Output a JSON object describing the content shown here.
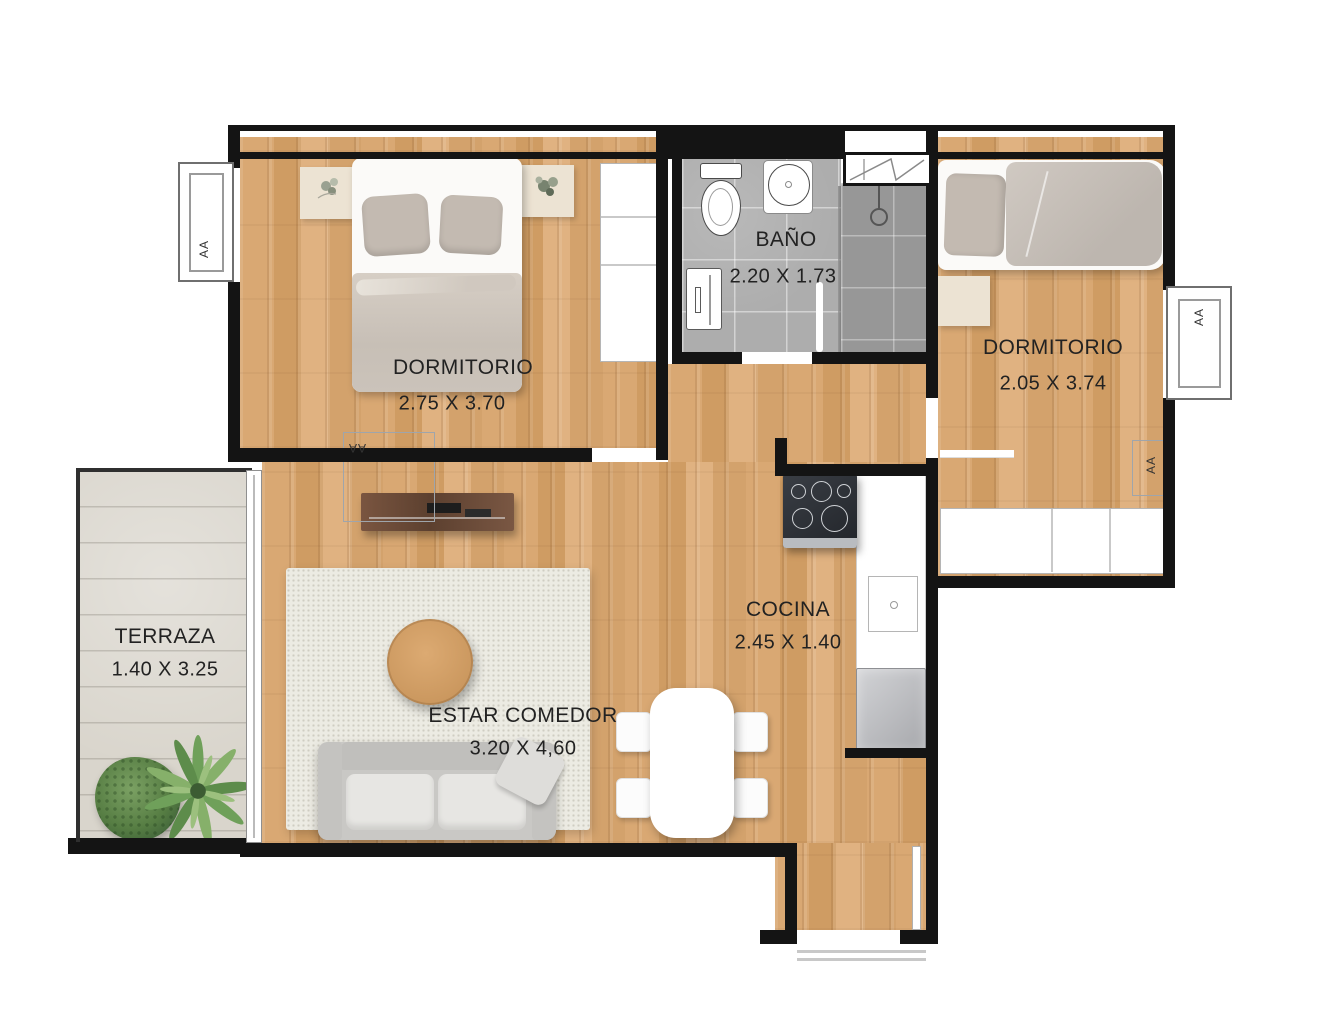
{
  "rooms": {
    "dormitorio1": {
      "name": "DORMITORIO",
      "dims": "2.75 X 3.70"
    },
    "bano": {
      "name": "BAÑO",
      "dims": "2.20 X 1.73"
    },
    "dormitorio2": {
      "name": "DORMITORIO",
      "dims": "2.05 X 3.74"
    },
    "terraza": {
      "name": "TERRAZA",
      "dims": "1.40 X 3.25"
    },
    "cocina": {
      "name": "COCINA",
      "dims": "2.45 X 1.40"
    },
    "estar_comedor": {
      "name": "ESTAR COMEDOR",
      "dims": "3.20 X 4,60"
    }
  },
  "marks": {
    "window_left": "AA",
    "window_right": "AA",
    "bedroom1_floor": "AA",
    "bedroom2_floor": "AA"
  },
  "colors": {
    "wall": "#141414",
    "wood": "#d6a574",
    "tile": "#adadad",
    "tile_dark": "#979797",
    "terrace": "#d9d5cc",
    "rug": "#ecebe3",
    "sofa": "#c9c8c5",
    "bedding": "#c3bab1",
    "nightstand": "#ece3d3",
    "console_wood": "#6e4a36",
    "label_text": "#222222"
  }
}
